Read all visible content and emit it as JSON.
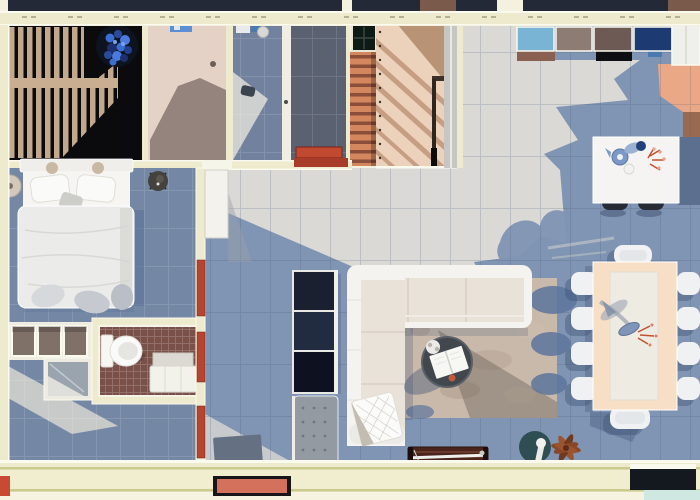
{
  "scene": {
    "description": "Top-down 3D rendered floor plan of an apartment with bedroom, bathroom, kitchen, living and dining areas",
    "view": "top-down architectural render",
    "width_px": 700,
    "height_px": 500
  },
  "colors": {
    "bg": "#f4f2df",
    "wall": "#edeacd",
    "wallEdge": "#fbfaef",
    "wallLine": "#c9cc8e",
    "wallInner": "#f0eecf",
    "wallLower": "#f6f4e0",
    "topStrip": "#232936",
    "topStripBrown": "#7a5a4a",
    "deckBlack": "#0b0b0d",
    "deckSlat": "#c2a88c",
    "deckBand": "#c9ae92",
    "terraceFloor": "#e4d2c6",
    "terraceShadow": "#8d7d76",
    "blueRoomFloor": "#72829e",
    "grayRoomFloor": "#5a6170",
    "stairBg": "#8a4e3a",
    "stairSlat": "#d4875f",
    "woodDeck": "#ecd2bb",
    "woodShadow": "#bb9175",
    "woodShadowDeep": "#b08868",
    "grayStrip": "#c6c6c3",
    "greatFloorLight": "#dad9d5",
    "greatFloorBlue": "#8095b3",
    "salmon": "#eba887",
    "patchBrown": "#9a6a50",
    "bedroomFloor": "#7488a6",
    "corridorLight": "#d2d2ce",
    "doorRed": "#b5452f",
    "doorBarRed": "#a83c28",
    "matRed": "#c0492f",
    "doormatSalmon": "#d4715c",
    "cornerRed": "#c84a32",
    "mosaic": "#7a5148",
    "showerGray": "#9aa4ae",
    "wardrobeBrown": "#7f7068",
    "white": "#f4f3ef",
    "sofaCream": "#e9e2d9",
    "consoleDark": "#1a2030",
    "consoleDark2": "#222c40",
    "consoleDark3": "#0e1220",
    "ottoman": "#939aa2",
    "rug": "#c9b9ab",
    "rugDark": "#6f655a",
    "rugBlue": "#5d749c",
    "coffeeTable": "#42474e",
    "benchBrown": "#4a241c",
    "lampTeal": "#2e4e54",
    "plantRust": "#8a4628",
    "plantBlue": "#3a6ed0",
    "potNavy": "#0d1420",
    "diningTable": "#f6dfc4",
    "runner": "#edebe2",
    "chairWhite": "#f0f1f3",
    "shadowNavy": "#3d4f72",
    "island": "#f5f4f2",
    "islandShadow": "#5d6f8e",
    "counterBlue": "#79b4d4",
    "counterBrown": "#8a6150",
    "counterTaupe": "#8c7c74",
    "counterDarkTaupe": "#6e5a54",
    "counterNavy": "#1e3a72",
    "counterBlack": "#0c0e12",
    "fridge": "#efefeb",
    "windowDark": "#14191f",
    "teal": "#cfe8e2",
    "bedWhite": "#ebebe9",
    "bedSheet": "#f6f5f2",
    "pillow": "#fafaf8",
    "bedShadow": "#5a7093",
    "toiletWhite": "#fafaf8",
    "vanity": "#f2f1ea",
    "stepGray": "#dbd9d2"
  },
  "rooms": [
    {
      "id": "balcony-deck",
      "label": "Dark slatted balcony deck with blue potted plant"
    },
    {
      "id": "terrace-room",
      "label": "Beige-floored terrace room"
    },
    {
      "id": "blue-tile-room",
      "label": "Blue tiled utility room"
    },
    {
      "id": "gray-tile-room",
      "label": "Dark gray tiled room with red mat"
    },
    {
      "id": "entry-stairs",
      "label": "Terracotta slatted entry stairs"
    },
    {
      "id": "entry-deck",
      "label": "Wooden entry deck with railing shadows"
    },
    {
      "id": "kitchen",
      "label": "Kitchen with colored counters and island"
    },
    {
      "id": "bedroom",
      "label": "Bedroom with double bed"
    },
    {
      "id": "bathroom",
      "label": "Bathroom with toilet and vanity"
    },
    {
      "id": "hallway",
      "label": "Hallway with entrance mats"
    },
    {
      "id": "living-room",
      "label": "Living room with L-shaped sofa and rug"
    },
    {
      "id": "dining-area",
      "label": "Dining area with long table"
    }
  ],
  "furniture": [
    {
      "id": "double-bed",
      "label": "Double bed with white duvet and two pillows",
      "room": "bedroom"
    },
    {
      "id": "bedside-lamp",
      "label": "Round bedside lamp",
      "room": "bedroom"
    },
    {
      "id": "bedside-stool",
      "label": "Round dark stool",
      "room": "bedroom"
    },
    {
      "id": "wardrobe",
      "label": "Three-panel wardrobe",
      "room": "bedroom"
    },
    {
      "id": "shower",
      "label": "Glass shower enclosure",
      "room": "bathroom"
    },
    {
      "id": "toilet",
      "label": "White toilet",
      "room": "bathroom"
    },
    {
      "id": "vanity-cabinet",
      "label": "White vanity cabinet",
      "room": "bathroom"
    },
    {
      "id": "media-console",
      "label": "Dark media console",
      "room": "living-room"
    },
    {
      "id": "ottoman",
      "label": "Gray tufted ottoman",
      "room": "living-room"
    },
    {
      "id": "sofa",
      "label": "L-shaped cream sectional sofa with throw blanket",
      "room": "living-room"
    },
    {
      "id": "area-rug",
      "label": "Mottled beige and blue area rug",
      "room": "living-room"
    },
    {
      "id": "coffee-table",
      "label": "Round dark coffee table with open book",
      "room": "living-room"
    },
    {
      "id": "wood-bench",
      "label": "Dark wooden slat bench",
      "room": "living-room"
    },
    {
      "id": "floor-lamp",
      "label": "Teal arc floor lamp",
      "room": "living-room"
    },
    {
      "id": "potted-plant",
      "label": "Rust-leaved plant",
      "room": "living-room"
    },
    {
      "id": "dining-table",
      "label": "Long cream dining table with runner and vase",
      "room": "dining-area"
    },
    {
      "id": "dining-chairs",
      "label": "White dining chairs",
      "room": "dining-area"
    },
    {
      "id": "kitchen-island",
      "label": "White kitchen island with teapot and flowers",
      "room": "kitchen"
    },
    {
      "id": "bar-stools",
      "label": "Dark bar stools",
      "room": "kitchen"
    },
    {
      "id": "counters",
      "label": "Kitchen counter run with blue, brown, taupe and navy cabinets",
      "room": "kitchen"
    },
    {
      "id": "refrigerator",
      "label": "White refrigerator",
      "room": "kitchen"
    },
    {
      "id": "doormat",
      "label": "Salmon entrance doormat",
      "room": "hallway"
    },
    {
      "id": "entry-mat",
      "label": "Gray entry mat",
      "room": "hallway"
    },
    {
      "id": "blue-plant",
      "label": "Blue flowering plant in round pot",
      "room": "balcony-deck"
    }
  ],
  "counts": {
    "dining_chairs": 10,
    "bar_stools": 2,
    "wardrobe_panels": 3,
    "red_doors": 4
  }
}
